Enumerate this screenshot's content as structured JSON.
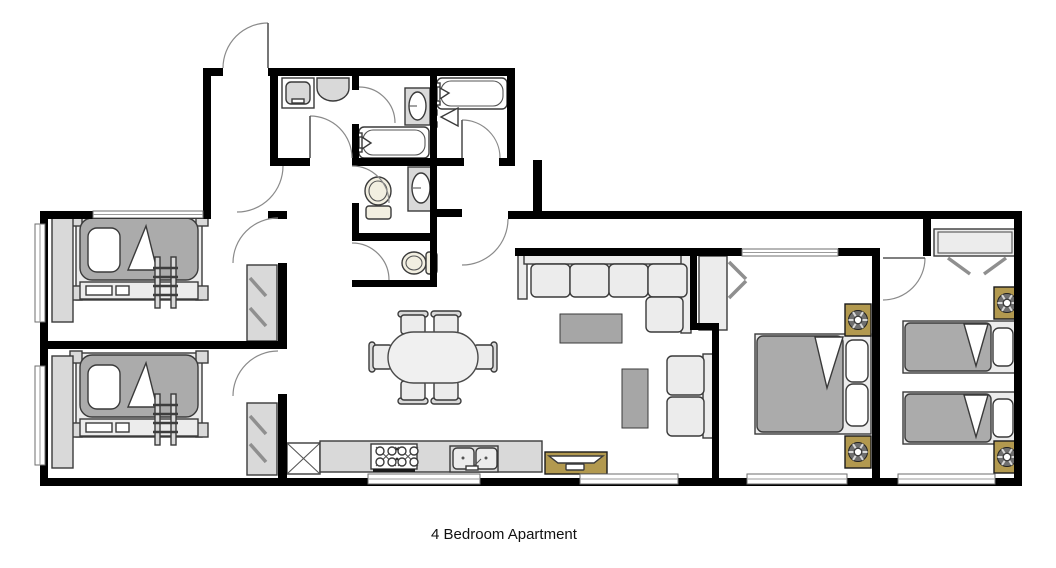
{
  "floorplan": {
    "caption": "4 Bedroom Apartment",
    "rooms": [
      {
        "id": "bedroom-1",
        "furniture": [
          "bunk-bed",
          "ladder",
          "wardrobe",
          "closet-with-hangers",
          "window"
        ]
      },
      {
        "id": "bedroom-2",
        "furniture": [
          "bunk-bed",
          "ladder",
          "wardrobe",
          "closet-with-hangers",
          "window"
        ]
      },
      {
        "id": "master-bedroom",
        "furniture": [
          "double-bed",
          "nightstand-with-lamp",
          "nightstand-with-lamp",
          "closet-with-hangers",
          "window"
        ]
      },
      {
        "id": "bedroom-4",
        "furniture": [
          "twin-bed",
          "twin-bed",
          "nightstand-with-lamp",
          "nightstand-with-lamp",
          "closet-with-hangers",
          "window"
        ]
      },
      {
        "id": "bathroom-1",
        "furniture": [
          "washing-machine",
          "sink"
        ]
      },
      {
        "id": "bathroom-2",
        "furniture": [
          "bathtub",
          "vanity-sink"
        ]
      },
      {
        "id": "bathroom-3",
        "furniture": [
          "bathtub",
          "shower-head"
        ]
      },
      {
        "id": "wc-1",
        "furniture": [
          "toilet",
          "vanity-sink"
        ]
      },
      {
        "id": "wc-2",
        "furniture": [
          "toilet"
        ]
      },
      {
        "id": "kitchen",
        "furniture": [
          "counter",
          "stove-4-burner",
          "double-sink",
          "cabinet-x",
          "window"
        ]
      },
      {
        "id": "dining-area",
        "furniture": [
          "oval-table",
          "chair",
          "chair",
          "chair",
          "chair",
          "chair",
          "chair"
        ]
      },
      {
        "id": "living-room",
        "furniture": [
          "sectional-sofa",
          "coffee-table",
          "side-table",
          "loveseat",
          "tv-stand",
          "window"
        ]
      },
      {
        "id": "entry-hall",
        "furniture": [
          "entrance-door"
        ]
      },
      {
        "id": "hallway",
        "furniture": []
      }
    ],
    "counts": {
      "bedrooms": 4,
      "bathrooms": 3,
      "toilets": 2,
      "beds": 5,
      "nightstands": 4,
      "windows": 8,
      "doors": 11
    }
  },
  "colors": {
    "wall": "#000000",
    "outline": "#3a3a3a",
    "furniture": "#d9d9d9",
    "furnitureLight": "#ececec",
    "mattress": "#ababab",
    "grayTable": "#a6a6a6",
    "tan": "#b2994f",
    "fixture": "#f2efe1",
    "caption": "#111111"
  }
}
